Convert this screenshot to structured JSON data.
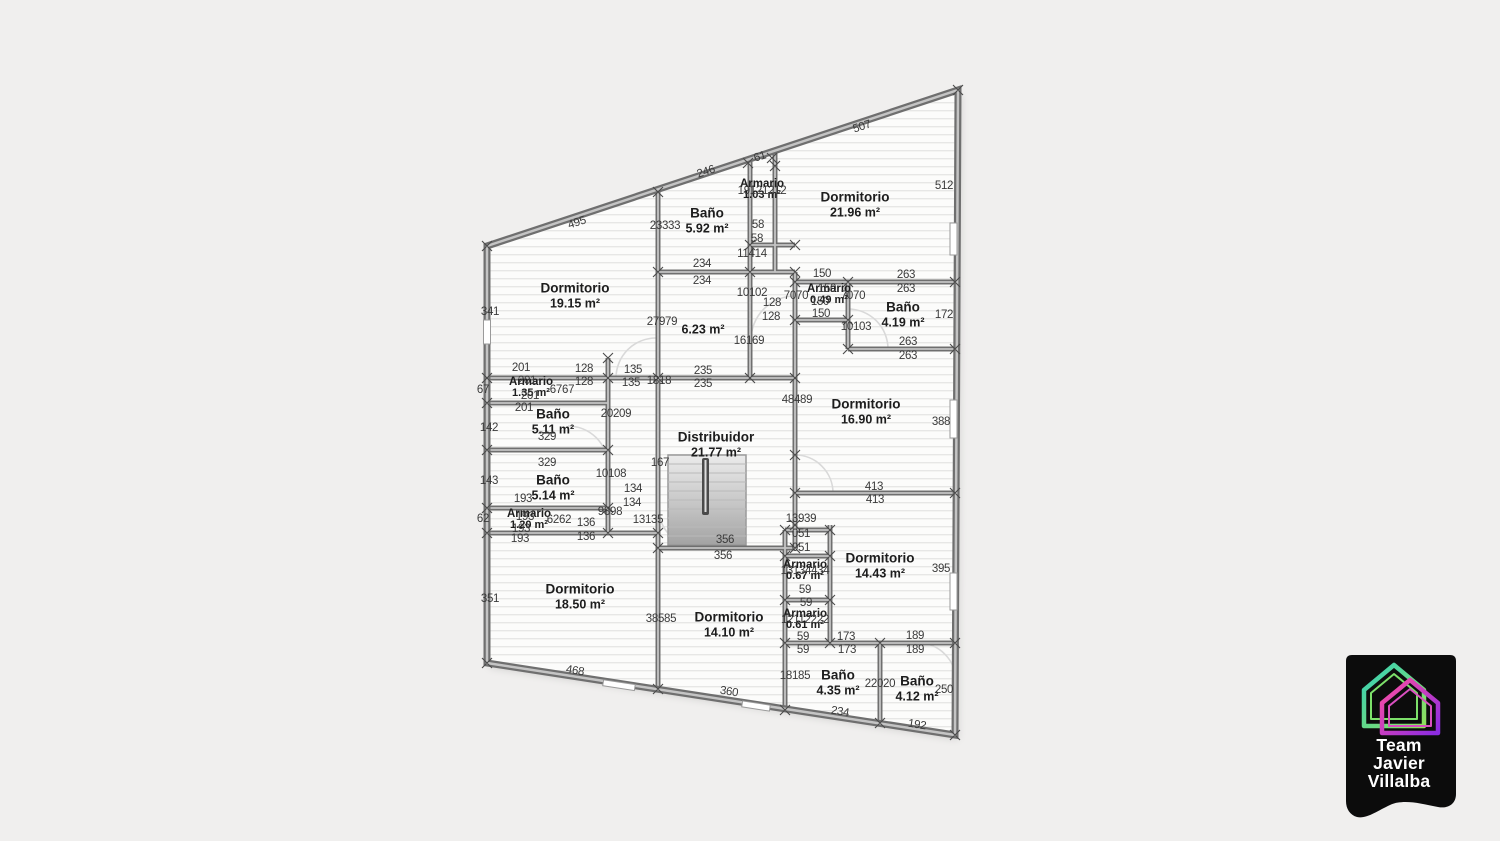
{
  "plan": {
    "rooms": [
      {
        "name": "Dormitorio",
        "area": "19.15 m²",
        "x": 575,
        "y": 296
      },
      {
        "name": "Baño",
        "area": "5.92 m²",
        "x": 707,
        "y": 221
      },
      {
        "name": "Armario",
        "area": "1.03 m²",
        "x": 762,
        "y": 190
      },
      {
        "name": "Dormitorio",
        "area": "21.96 m²",
        "x": 855,
        "y": 205
      },
      {
        "name": "",
        "area": "6.23 m²",
        "x": 703,
        "y": 330
      },
      {
        "name": "Armario",
        "area": "0.49 m²",
        "x": 829,
        "y": 295
      },
      {
        "name": "Baño",
        "area": "4.19 m²",
        "x": 903,
        "y": 315
      },
      {
        "name": "Dormitorio",
        "area": "16.90 m²",
        "x": 866,
        "y": 412
      },
      {
        "name": "Armario",
        "area": "1.35 m²",
        "x": 531,
        "y": 388
      },
      {
        "name": "Baño",
        "area": "5.11 m²",
        "x": 553,
        "y": 422
      },
      {
        "name": "Baño",
        "area": "5.14 m²",
        "x": 553,
        "y": 488
      },
      {
        "name": "Armario",
        "area": "1.20 m²",
        "x": 529,
        "y": 520
      },
      {
        "name": "Distribuidor",
        "area": "21.77 m²",
        "x": 716,
        "y": 445
      },
      {
        "name": "Dormitorio",
        "area": "14.43 m²",
        "x": 880,
        "y": 566
      },
      {
        "name": "Armario",
        "area": "0.67 m²",
        "x": 805,
        "y": 571
      },
      {
        "name": "Armario",
        "area": "0.61 m²",
        "x": 805,
        "y": 620
      },
      {
        "name": "Dormitorio",
        "area": "18.50 m²",
        "x": 580,
        "y": 597
      },
      {
        "name": "Dormitorio",
        "area": "14.10 m²",
        "x": 729,
        "y": 625
      },
      {
        "name": "Baño",
        "area": "4.35 m²",
        "x": 838,
        "y": 683
      },
      {
        "name": "Baño",
        "area": "4.12 m²",
        "x": 917,
        "y": 689
      }
    ],
    "dimensions": [
      {
        "text": "495",
        "x": 577,
        "y": 223,
        "r": -18
      },
      {
        "text": "246",
        "x": 706,
        "y": 172,
        "r": -18
      },
      {
        "text": "61",
        "x": 760,
        "y": 157,
        "r": -18
      },
      {
        "text": "507",
        "x": 862,
        "y": 127,
        "r": -18
      },
      {
        "text": "512",
        "x": 944,
        "y": 186
      },
      {
        "text": "341",
        "x": 490,
        "y": 312
      },
      {
        "text": "172",
        "x": 944,
        "y": 315
      },
      {
        "text": "388",
        "x": 941,
        "y": 422
      },
      {
        "text": "395",
        "x": 941,
        "y": 569
      },
      {
        "text": "250",
        "x": 944,
        "y": 690
      },
      {
        "text": "142",
        "x": 489,
        "y": 428
      },
      {
        "text": "143",
        "x": 489,
        "y": 481
      },
      {
        "text": "67",
        "x": 483,
        "y": 390
      },
      {
        "text": "62",
        "x": 483,
        "y": 519
      },
      {
        "text": "351",
        "x": 490,
        "y": 599
      },
      {
        "text": "23333",
        "x": 665,
        "y": 226
      },
      {
        "text": "19121212",
        "x": 762,
        "y": 191
      },
      {
        "text": "58",
        "x": 758,
        "y": 225
      },
      {
        "text": "58",
        "x": 757,
        "y": 239
      },
      {
        "text": "11414",
        "x": 752,
        "y": 254
      },
      {
        "text": "234",
        "x": 702,
        "y": 264
      },
      {
        "text": "234",
        "x": 702,
        "y": 281
      },
      {
        "text": "10102",
        "x": 752,
        "y": 293
      },
      {
        "text": "128",
        "x": 772,
        "y": 303
      },
      {
        "text": "128",
        "x": 771,
        "y": 317
      },
      {
        "text": "150",
        "x": 822,
        "y": 274
      },
      {
        "text": "263",
        "x": 906,
        "y": 275
      },
      {
        "text": "263",
        "x": 906,
        "y": 289
      },
      {
        "text": "150",
        "x": 827,
        "y": 289
      },
      {
        "text": "150",
        "x": 820,
        "y": 302
      },
      {
        "text": "150",
        "x": 821,
        "y": 314
      },
      {
        "text": "7070",
        "x": 796,
        "y": 296
      },
      {
        "text": "7070",
        "x": 853,
        "y": 296
      },
      {
        "text": "10103",
        "x": 856,
        "y": 327
      },
      {
        "text": "263",
        "x": 908,
        "y": 342
      },
      {
        "text": "263",
        "x": 908,
        "y": 356
      },
      {
        "text": "27979",
        "x": 662,
        "y": 322
      },
      {
        "text": "16169",
        "x": 749,
        "y": 341
      },
      {
        "text": "48489",
        "x": 797,
        "y": 400
      },
      {
        "text": "235",
        "x": 703,
        "y": 371
      },
      {
        "text": "235",
        "x": 703,
        "y": 384
      },
      {
        "text": "135",
        "x": 633,
        "y": 370
      },
      {
        "text": "135",
        "x": 631,
        "y": 383
      },
      {
        "text": "1818",
        "x": 659,
        "y": 381
      },
      {
        "text": "128",
        "x": 584,
        "y": 369
      },
      {
        "text": "128",
        "x": 584,
        "y": 382
      },
      {
        "text": "201",
        "x": 521,
        "y": 368
      },
      {
        "text": "201",
        "x": 527,
        "y": 381
      },
      {
        "text": "201",
        "x": 530,
        "y": 396
      },
      {
        "text": "201",
        "x": 524,
        "y": 408
      },
      {
        "text": "6767",
        "x": 562,
        "y": 390
      },
      {
        "text": "20209",
        "x": 616,
        "y": 414
      },
      {
        "text": "329",
        "x": 547,
        "y": 437
      },
      {
        "text": "329",
        "x": 547,
        "y": 463
      },
      {
        "text": "10108",
        "x": 611,
        "y": 474
      },
      {
        "text": "134",
        "x": 633,
        "y": 489
      },
      {
        "text": "134",
        "x": 632,
        "y": 503
      },
      {
        "text": "167",
        "x": 660,
        "y": 463
      },
      {
        "text": "9898",
        "x": 610,
        "y": 512
      },
      {
        "text": "6262",
        "x": 559,
        "y": 520
      },
      {
        "text": "136",
        "x": 586,
        "y": 523
      },
      {
        "text": "136",
        "x": 586,
        "y": 537
      },
      {
        "text": "193",
        "x": 523,
        "y": 499
      },
      {
        "text": "193",
        "x": 525,
        "y": 517
      },
      {
        "text": "193",
        "x": 521,
        "y": 529
      },
      {
        "text": "193",
        "x": 520,
        "y": 539
      },
      {
        "text": "13135",
        "x": 648,
        "y": 520
      },
      {
        "text": "38585",
        "x": 661,
        "y": 619
      },
      {
        "text": "356",
        "x": 725,
        "y": 540
      },
      {
        "text": "356",
        "x": 723,
        "y": 556
      },
      {
        "text": "13939",
        "x": 801,
        "y": 519
      },
      {
        "text": "051",
        "x": 801,
        "y": 534
      },
      {
        "text": "051",
        "x": 801,
        "y": 548
      },
      {
        "text": "13134434",
        "x": 805,
        "y": 571
      },
      {
        "text": "59",
        "x": 805,
        "y": 590
      },
      {
        "text": "59",
        "x": 806,
        "y": 603
      },
      {
        "text": "12112222",
        "x": 805,
        "y": 620
      },
      {
        "text": "59",
        "x": 803,
        "y": 637
      },
      {
        "text": "59",
        "x": 803,
        "y": 650
      },
      {
        "text": "173",
        "x": 846,
        "y": 637
      },
      {
        "text": "173",
        "x": 847,
        "y": 650
      },
      {
        "text": "189",
        "x": 915,
        "y": 636
      },
      {
        "text": "189",
        "x": 915,
        "y": 650
      },
      {
        "text": "413",
        "x": 874,
        "y": 487
      },
      {
        "text": "413",
        "x": 875,
        "y": 500
      },
      {
        "text": "18185",
        "x": 795,
        "y": 676
      },
      {
        "text": "22020",
        "x": 880,
        "y": 684
      },
      {
        "text": "468",
        "x": 575,
        "y": 671,
        "r": 9
      },
      {
        "text": "360",
        "x": 729,
        "y": 692,
        "r": 9
      },
      {
        "text": "234",
        "x": 840,
        "y": 712,
        "r": 9
      },
      {
        "text": "192",
        "x": 917,
        "y": 725,
        "r": 9
      }
    ]
  },
  "logo": {
    "lines": [
      "Team",
      "Javier",
      "Villalba"
    ],
    "icon": "overlapping-houses",
    "badge_color": "#0c0c0c",
    "icon_colors": [
      "#35d0b8",
      "#8fe05c",
      "#ff4fa0",
      "#8a2be2"
    ]
  },
  "colors": {
    "background": "#f0efee",
    "wall": "#6f6f6f",
    "wall_fill": "#c4c4c4",
    "floor_line": "#e7e7e6",
    "dimension_text": "#3a3a3a",
    "room_text": "#1d1d1d"
  }
}
